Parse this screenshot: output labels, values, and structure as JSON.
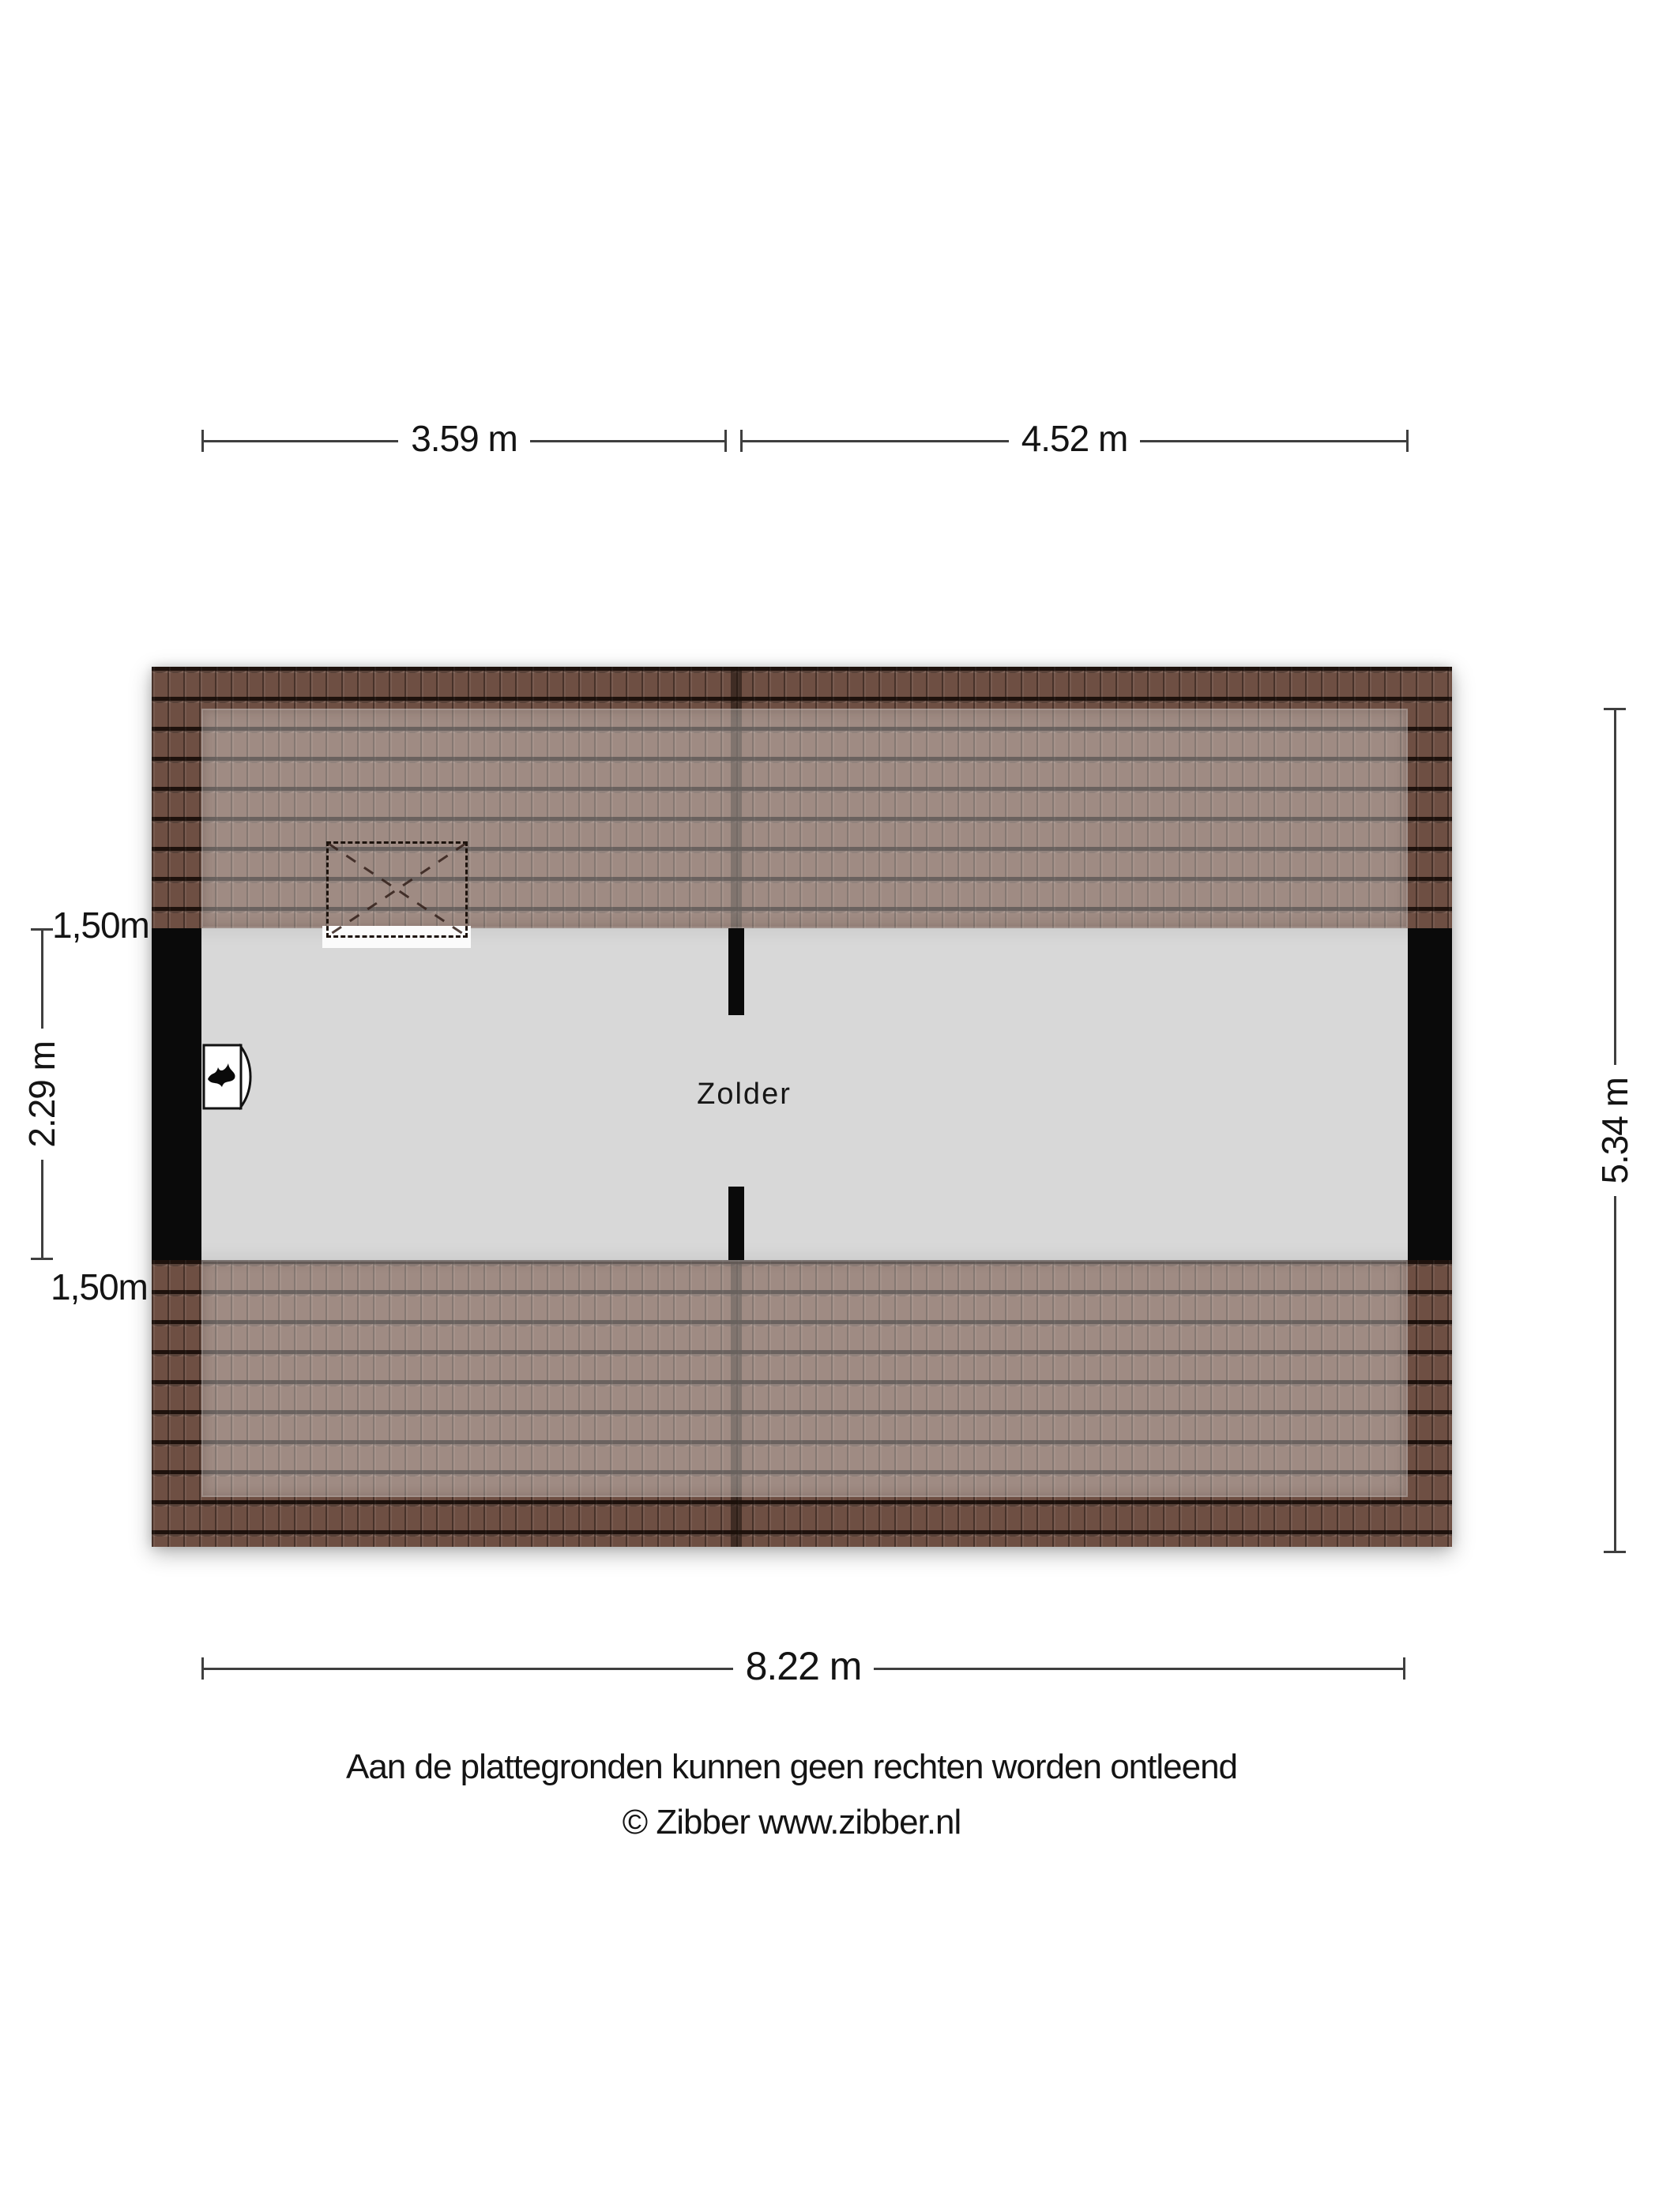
{
  "room": {
    "label": "Zolder"
  },
  "dimensions": {
    "top_left": "3.59 m",
    "top_right": "4.52 m",
    "side_top": "1,50m",
    "side_middle": "2.29 m",
    "side_bottom": "1,50m",
    "right": "5.34 m",
    "bottom": "8.22 m"
  },
  "footer": {
    "line1": "Aan de plattegronden kunnen geen rechten worden ontleend",
    "line2": "© Zibber www.zibber.nl"
  },
  "icons": {
    "heater": "flame-icon",
    "skylight": "skylight-cross-icon"
  },
  "colors": {
    "roof_base": "#6e4f43",
    "roof_seam": "#2a1a12",
    "roof_overlay": "rgba(255,255,255,0.34)",
    "floor": "#d8d8d8",
    "wall": "#0a0a0a",
    "dimension_line": "#3f3f3f"
  }
}
